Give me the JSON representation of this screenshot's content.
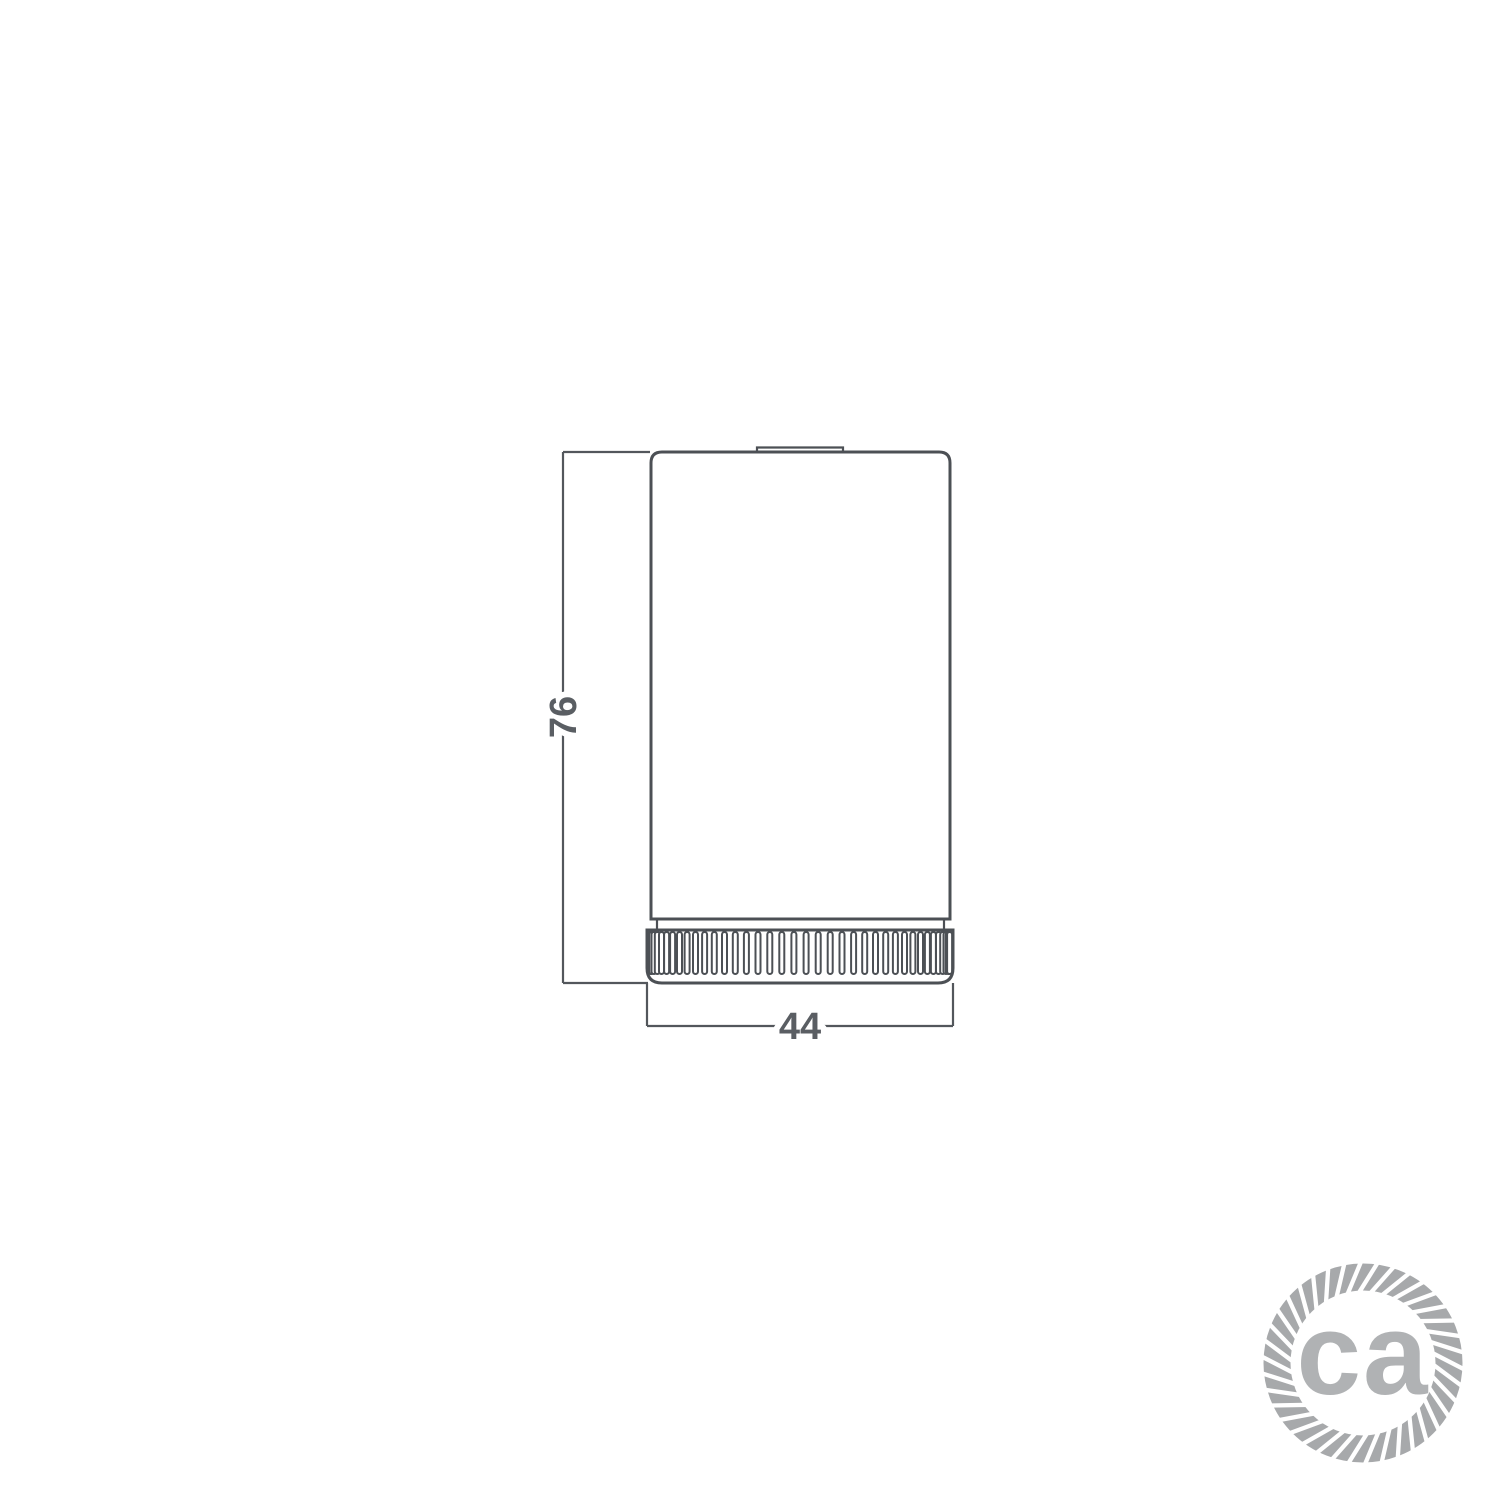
{
  "page": {
    "background_color": "#ffffff"
  },
  "drawing": {
    "type": "technical-dimension-drawing",
    "subject": "cylindrical lamp holder with knurled ring, front elevation",
    "line_color": "#4c5055",
    "dim_text_color": "#5a5e63",
    "dimensions": {
      "height": {
        "value": "76",
        "orientation": "vertical"
      },
      "width": {
        "value": "44",
        "orientation": "horizontal"
      }
    }
  },
  "logo": {
    "text": "ca",
    "text_color": "#b0b2b4",
    "rope_color": "#a7a9ab",
    "shape": "twisted-rope-circle"
  }
}
